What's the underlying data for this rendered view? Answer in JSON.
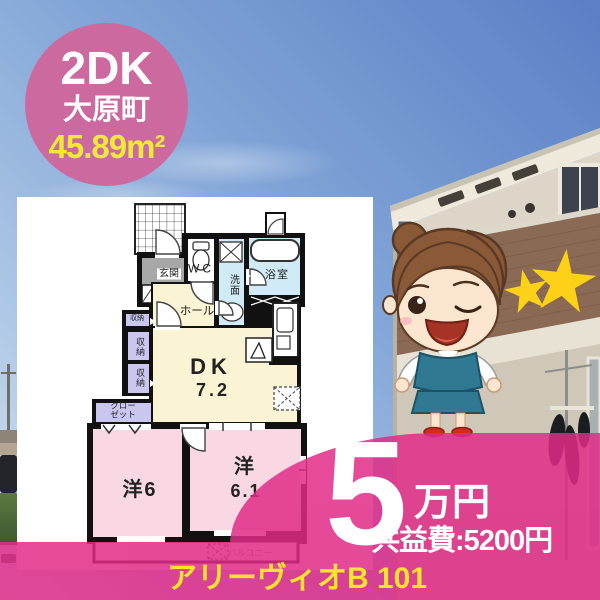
{
  "listing_badge": {
    "layout": "2DK",
    "town": "大原町",
    "area": "45.89m²"
  },
  "price_overlay": {
    "rent_value": "5",
    "rent_unit": "万円",
    "common_fee": "共益費:5200円"
  },
  "property_name": "アリーヴィオB 101",
  "floor_plan": {
    "labels": {
      "entrance": "玄関",
      "toilet": "WC",
      "washroom": "洗面",
      "bathroom": "浴室",
      "hallway": "ホール",
      "storage_1": "収納",
      "storage_2": "収納",
      "storage_3": "収納",
      "closet": "クロー\nゼット",
      "dining_kitchen": "DK",
      "dining_kitchen_size": "7.2",
      "western_room_6": "洋6",
      "western_room_61_label": "洋",
      "western_room_61_size": "6.1",
      "balcony": "バルコニー"
    }
  },
  "colors": {
    "badge_pink": "#cc6aa0",
    "overlay_pink": "#e02b87",
    "badge_area_yellow": "#f0e83c",
    "property_name_yellow": "#fce42c",
    "plan_cream": "#fbf4d4",
    "plan_water_blue": "#d0eaf6",
    "plan_room_pink": "#f9d8e4",
    "plan_storage_lavender": "#c9c7ef",
    "star_gold": "#fcd117"
  }
}
